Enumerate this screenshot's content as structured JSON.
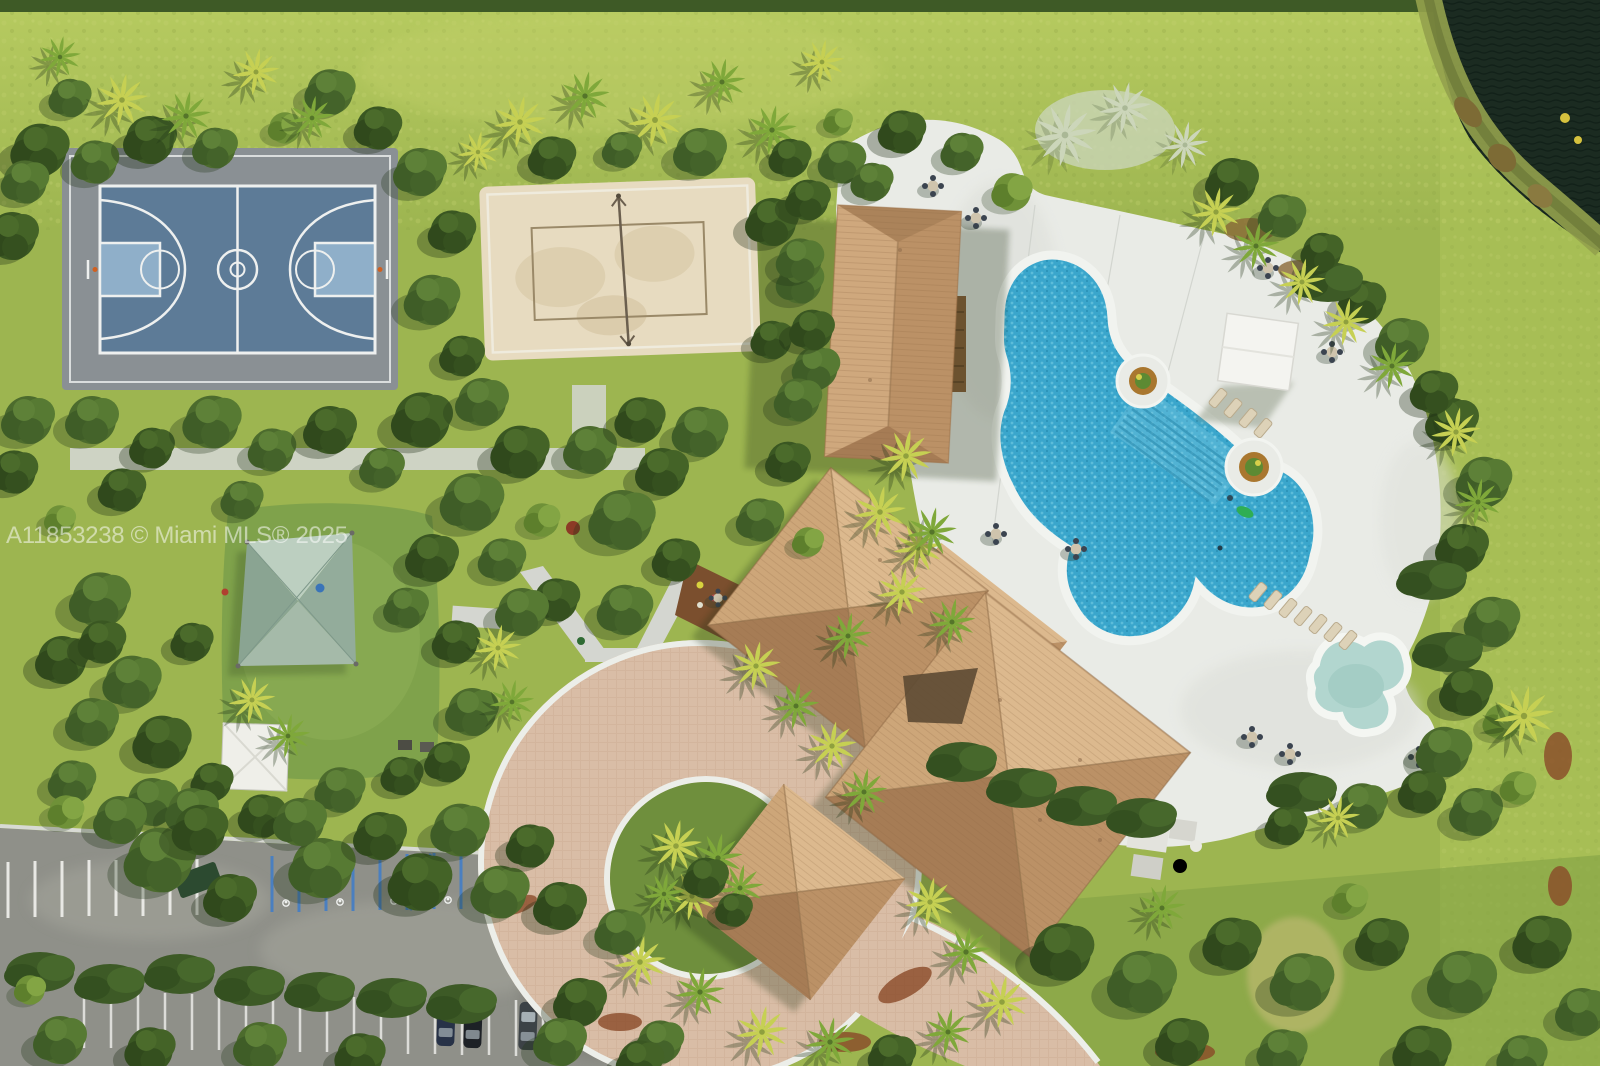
{
  "scene": {
    "type": "aerial-drone-photo",
    "subject": "Aerial view of a community clubhouse with basketball court, sand volleyball court, playground, freeform pool, kiddie pool, paver motor court and parking lot beside a lake",
    "watermark": "A11853238 © Miami MLS® 2025"
  },
  "palette": {
    "grass_base": "#9db550",
    "grass_light": "#b7cb60",
    "grass_dark": "#85a546",
    "tree_dark": "#35511f",
    "tree_mid": "#4c6b2d",
    "tree_light": "#6f9138",
    "palm_green": "#7fa83a",
    "palm_bright": "#c6d053",
    "palm_silver": "#ccd6ba",
    "sand": "#e7dbc0",
    "apron_gray": "#8a9094",
    "court_blue": "#5d7b97",
    "court_key": "#8fafc9",
    "court_line": "#eef0ef",
    "concrete": "#d4d6d0",
    "deck_white": "#e9ebe6",
    "paver": "#d9bda6",
    "paver_curb": "#eceee9",
    "roof_tan": "#c89e74",
    "roof_light": "#dcb98e",
    "roof_dark": "#a67c55",
    "asphalt": "#8f9089",
    "stripe_blue": "#4a7fc0",
    "pool_water": "#3aa6cc",
    "kiddie_water": "#b2d6cf",
    "lake": "#1b2b21",
    "canopy_teal": "#afc2b4",
    "mulch": "#7b4f2e",
    "turf": "#7fa24b",
    "watermark_color": "#ffffff"
  },
  "landmarks": [
    "basketball-court",
    "sand-volleyball-court",
    "playground-shade-canopy",
    "clubhouse",
    "pool-house",
    "porte-cochere",
    "swimming-pool",
    "kiddie-pool",
    "pool-cabana",
    "pool-deck",
    "paver-motor-court",
    "parking-lot",
    "lake"
  ]
}
